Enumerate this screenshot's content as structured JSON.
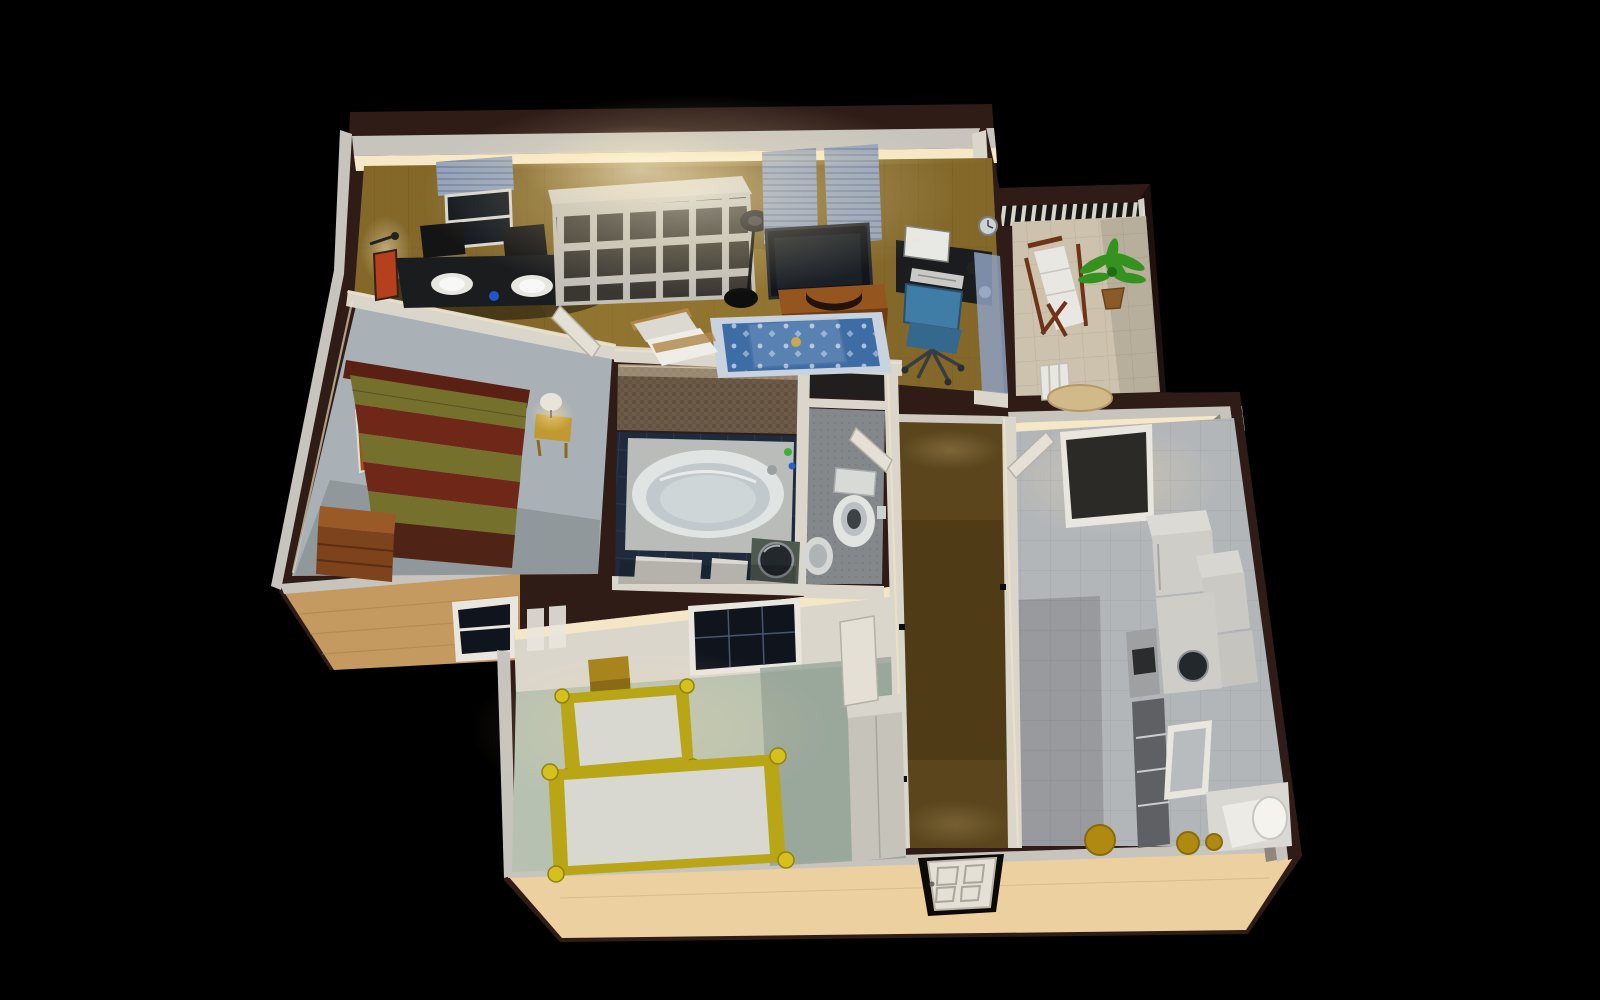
{
  "meta": {
    "description": "Aerial 3/4 perspective 3D render of a furnished apartment floor plan on a black background",
    "render_style": "home-design 3D visualization, warm interior lighting, night surround",
    "background": "#000000"
  },
  "palette": {
    "bg": "#000000",
    "rim": "#2f1c17",
    "rimDark": "#1f120e",
    "grayTop": "#c7c4be",
    "wallFace": "#dbd6cc",
    "wallLit": "#f6e8c6",
    "warmEdge": "#f3e5c2",
    "shadeFace": "#8d877c",
    "tanWall": "#ecd0a0",
    "tanSiding": "#c59a60",
    "sidingLine": "#a87f48",
    "wood": "#83682a",
    "woodLine": "#5e4a1e",
    "woodLit": "#b3923f",
    "carpetBedroom": "#a9b1b6",
    "mosaic": "#6d5b49",
    "mosaicDark": "#5c4b3a",
    "bathNavy": "#1f2b3d",
    "bathGrout": "#31405a",
    "tubDeck": "#b9bcb8",
    "tubWhite": "#e0e4e3",
    "tubInner": "#c2c9cc",
    "sinkCab": "#4e5a50",
    "basinDark": "#23282c",
    "wcFloor": "#85888b",
    "wcSpeck": "#6f7277",
    "alcoveDark": "#211f1d",
    "hallCarpet": "#5a451c",
    "hallDark": "#473612",
    "kidsFloor": "#b7c1b2",
    "kidsFloorDark": "#8a9a8f",
    "kitchenTile": "#b3b6b9",
    "tileLine": "#999da1",
    "balconyTile": "#cdc2ae",
    "balconyLine": "#b7ab95",
    "white": "#efede7",
    "offWhite": "#dcd9d1",
    "boxFace": "#cfccc4",
    "boxSide": "#c2bfb7",
    "cubby": "#3a3732",
    "black": "#141414",
    "deskBlack": "#1b1c1e",
    "tvScreen": "#13151a",
    "tvFrame": "#272a30",
    "chairBlue": "#3f7da6",
    "chairBlueDark": "#34688c",
    "blinds": "#94a2ba",
    "blindLine": "#6c7d9c",
    "windowDark": "#10151d",
    "frameWhite": "#e9e6df",
    "rugBorder": "#c9d3df",
    "rugBlue": "#3e6da6",
    "rugMotif": "#bcd0e4",
    "standBrown": "#95551e",
    "standDark": "#6f3d14",
    "headboard": "#5a2014",
    "bedRed": "#6f2718",
    "bedOlive": "#75702c",
    "bedFoot": "#4f2416",
    "drawerTop": "#9a5a28",
    "drawerFront": "#7c431c",
    "drawerLine": "#5c2f12",
    "nightYellow": "#c09a30",
    "lampShade": "#e9e4da",
    "picOrange": "#b5401d",
    "picBrown": "#a34f1e",
    "kidsYellow": "#b9a616",
    "kidsYellowLit": "#d6c11c",
    "mattress": "#d8d8d1",
    "wardrobeFace": "#c6c3bb",
    "wardrobeTop": "#d8d5cd",
    "doorLeaf": "#e4e0d6",
    "doorEdge": "#b5b1a7",
    "green": "#35921f",
    "greenDark": "#1f6f12",
    "potBrown": "#8a5a28",
    "deckWood": "#6e3318",
    "deckFabric": "#e9e7e1",
    "stoolGold": "#b08a10",
    "heaterWhite": "#ecebe5",
    "shelfDark": "#5e6064",
    "ovenGray": "#9fa0a2",
    "blueWallpaper": "#8ea0c0"
  },
  "rooms": [
    {
      "id": "living-room",
      "label": "Living and dining room",
      "floor": "wood parquet",
      "furniture": [
        "black dining table",
        "two black chairs",
        "two white place settings",
        "wall lamp",
        "red wall picture",
        "window with blinds",
        "white cube bookshelf",
        "floor lamp",
        "flat screen TV",
        "brown TV sideboard",
        "two windows with blue blinds",
        "white armchair",
        "blue oriental rug",
        "glass coffee table with candle",
        "black computer desk",
        "monitor and keyboard",
        "blue office chair",
        "wall clock"
      ]
    },
    {
      "id": "balcony",
      "label": "Balcony",
      "floor": "stone tiles",
      "furniture": [
        "striped pergola band",
        "white railing",
        "wooden deck chair with white fabric",
        "potted palm plant",
        "round garden table",
        "white garden chair"
      ]
    },
    {
      "id": "bedroom",
      "label": "Bedroom",
      "floor": "gray carpet",
      "furniture": [
        "double bed with olive and red striped duvet",
        "dark red headboard",
        "yellow bedside table",
        "bedside lamp",
        "brown chest of drawers",
        "wall picture",
        "exterior window"
      ]
    },
    {
      "id": "bathroom",
      "label": "Bathroom",
      "floor": "navy blue tiles",
      "furniture": [
        "built-in bathtub",
        "brown mosaic wall",
        "washbasin cabinet with round basin",
        "partition walls"
      ]
    },
    {
      "id": "wc",
      "label": "Toilet room",
      "floor": "gray speckled tiles",
      "furniture": [
        "toilet with tank",
        "toilet paper holder",
        "small hand basin",
        "dark storage niche"
      ]
    },
    {
      "id": "hallway",
      "label": "Hallway",
      "floor": "brown carpet",
      "furniture": [
        "open doors to rooms",
        "door stoppers"
      ]
    },
    {
      "id": "kids-room",
      "label": "Children's bedroom",
      "floor": "pale green carpet",
      "furniture": [
        "two yellow single beds with white mattresses",
        "bedside cabinet",
        "white wardrobe",
        "dark window",
        "wall posters",
        "open door"
      ]
    },
    {
      "id": "kitchen",
      "label": "Kitchen",
      "floor": "light gray tiles",
      "furniture": [
        "fridge",
        "white wall cabinets",
        "counter with round sink",
        "oven",
        "dark shelf rack",
        "water heater cylinder",
        "yellow stools",
        "door to hallway",
        "dark doorway"
      ]
    },
    {
      "id": "entrance",
      "label": "Entrance",
      "floor": "exterior wall notch",
      "furniture": [
        "white paneled front door"
      ]
    }
  ]
}
